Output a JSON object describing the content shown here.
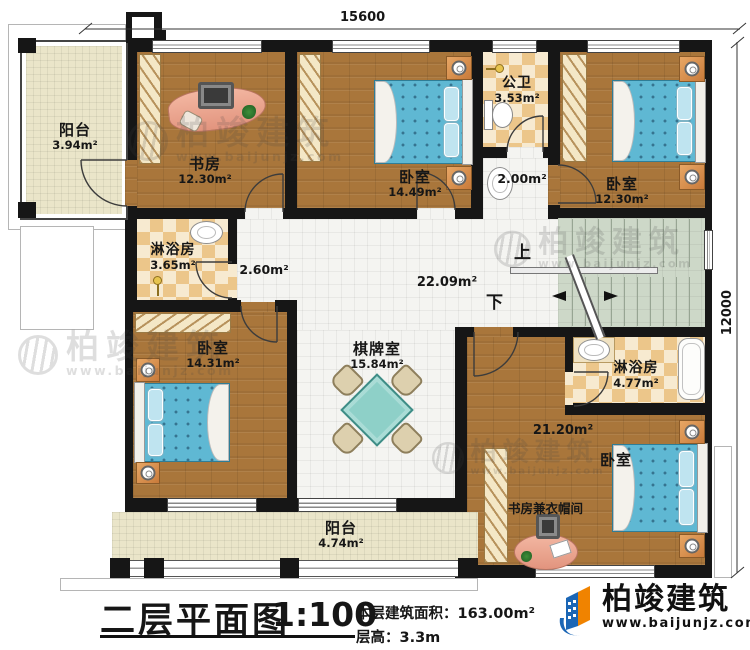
{
  "document": {
    "dimensions": {
      "top": "15600",
      "right": "12000"
    },
    "stairs": {
      "up": "上",
      "down": "下"
    },
    "rooms": {
      "balcony_tl": {
        "name": "阳台",
        "area": "3.94m²"
      },
      "study": {
        "name": "书房",
        "area": "12.30m²"
      },
      "bedroom_top_mid": {
        "name": "卧室",
        "area": "14.49m²"
      },
      "public_bath": {
        "name": "公卫",
        "area": "3.53m²"
      },
      "wash_area": {
        "area": "2.00m²"
      },
      "bedroom_top_right": {
        "name": "卧室",
        "area": "12.30m²"
      },
      "shower_left": {
        "name": "淋浴房",
        "area": "3.65m²"
      },
      "hall_west": {
        "area": "2.60m²"
      },
      "hall_main": {
        "area": "22.09m²"
      },
      "bedroom_left": {
        "name": "卧室",
        "area": "14.31m²"
      },
      "game_room": {
        "name": "棋牌室",
        "area": "15.84m²"
      },
      "shower_right": {
        "name": "淋浴房",
        "area": "4.77m²"
      },
      "bedroom_br": {
        "name": "卧室",
        "area": "21.20m²"
      },
      "study_cloak": {
        "name": "书房兼衣帽间"
      },
      "balcony_bottom": {
        "name": "阳台",
        "area": "4.74m²"
      }
    },
    "footer": {
      "title": "二层平面图",
      "scale": "1:100",
      "floor_area_label": "本层建筑面积：",
      "floor_area_value": "163.00m²",
      "floor_height_label": "层高：",
      "floor_height_value": "3.3m"
    },
    "brand": {
      "name": "柏竣建筑",
      "website": "www.baijunjz.com"
    },
    "watermark": {
      "name": "柏竣建筑",
      "website": "www.baijunjz.com"
    },
    "colors": {
      "wall": "#161616",
      "wood_floor": "#a9763b",
      "white_tile": "#f4f4f1",
      "balcony_tile": "#eae5c9",
      "checker_dark": "#ecc68a",
      "checker_light": "#f7ead0",
      "stair_floor": "#cdd8c8",
      "bed_teal": "#5fb8d3",
      "furniture_orange": "#d98c4a",
      "desk_pink": "#eda896",
      "table_teal": "#8ed0c8",
      "logo_blue": "#1b66b5",
      "logo_orange": "#f08300"
    }
  }
}
